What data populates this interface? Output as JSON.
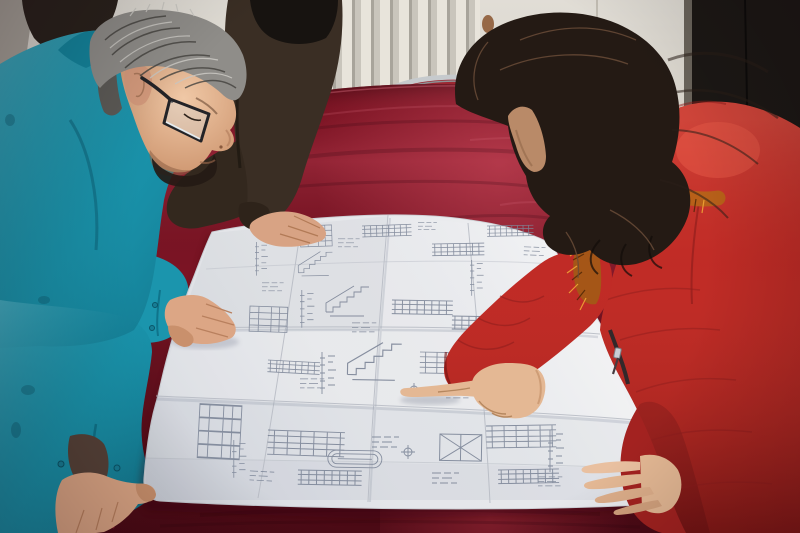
{
  "scene": {
    "description": "Two workers review a large folded engineering blueprint spread on a crimson velvet table: a gray-haired man in a teal work jacket and dark glasses leans over the sheet with both hands on it, while a woman in a red quilted down coat with an orange fur-trimmed hood points at a detail with her right index finger; a third person's dark-sleeved arm rests on the top edge of the drawing. Behind them are a cream wall with a white fin radiator, a red chair with a chrome frame, and a dark doorway panel on the right.",
    "setting": {
      "wall": "cream panelled wall with white radiator fins",
      "left_background": "dark shoulder of a bystander over a gray wall corner",
      "right_background": "dark doorway panel with gray frame",
      "furniture": [
        "large table covered in crimson velvet",
        "red chair with chrome tube frame behind the table"
      ]
    },
    "people": [
      {
        "id": "man-left",
        "hair": "gray, short",
        "accessories": [
          "dark rectangular glasses"
        ],
        "clothing": "teal chore jacket with snap-button cuffs",
        "pose": "leaning over the table, left hand on the sheet, right hand gripping the table corner"
      },
      {
        "id": "person-behind",
        "clothing": "dark brown jacket",
        "pose": "hand resting on the top edge of the blueprint"
      },
      {
        "id": "woman-right",
        "hair": "long dark wavy",
        "clothing": "red quilted down coat, orange fur hood trim, front zipper",
        "pose": "pointing at the blueprint with right index finger, left hand flat on the sheet"
      }
    ],
    "objects": [
      {
        "id": "blueprint",
        "type": "folded technical drawing sheet",
        "content": "stair sections, beam elevations, dimension chains, schedule tables, grid bubbles, oval tank detail",
        "fold_grid": "4x4 crease pattern"
      },
      {
        "id": "table",
        "material": "crimson velvet"
      },
      {
        "id": "radiator",
        "style": "vertical white fins"
      },
      {
        "id": "chair",
        "frame": "chrome tube",
        "upholstery": "red"
      }
    ]
  },
  "palette": {
    "wall": "#d7d2c8",
    "wall_shadow": "#a9a49b",
    "radiator_fin": "#e8e4db",
    "radiator_gap": "#b4b0a7",
    "door_dark": "#1c1815",
    "door_frame": "#6b655c",
    "table_red": "#7c1424",
    "table_highlight": "#a83344",
    "table_shadow": "#4c0b15",
    "paper": "#e8e9ec",
    "ink": "#7e8799",
    "crease": "#b6bac3",
    "jacket_teal": "#1b95ad",
    "jacket_shadow": "#0e6d85",
    "coat_red": "#bf2a25",
    "coat_highlight": "#e05848",
    "coat_shadow": "#7e1617",
    "fur_orange": "#b86019",
    "fur_highlight": "#f0a435",
    "hair_gray": "#8f8d89",
    "hair_dark": "#241a14",
    "skin": "#dca685",
    "skin_shadow": "#b07a55",
    "dark_jacket": "#3a2e24",
    "chair_chrome": "#c6cacd",
    "chair_red": "#9c2731"
  }
}
